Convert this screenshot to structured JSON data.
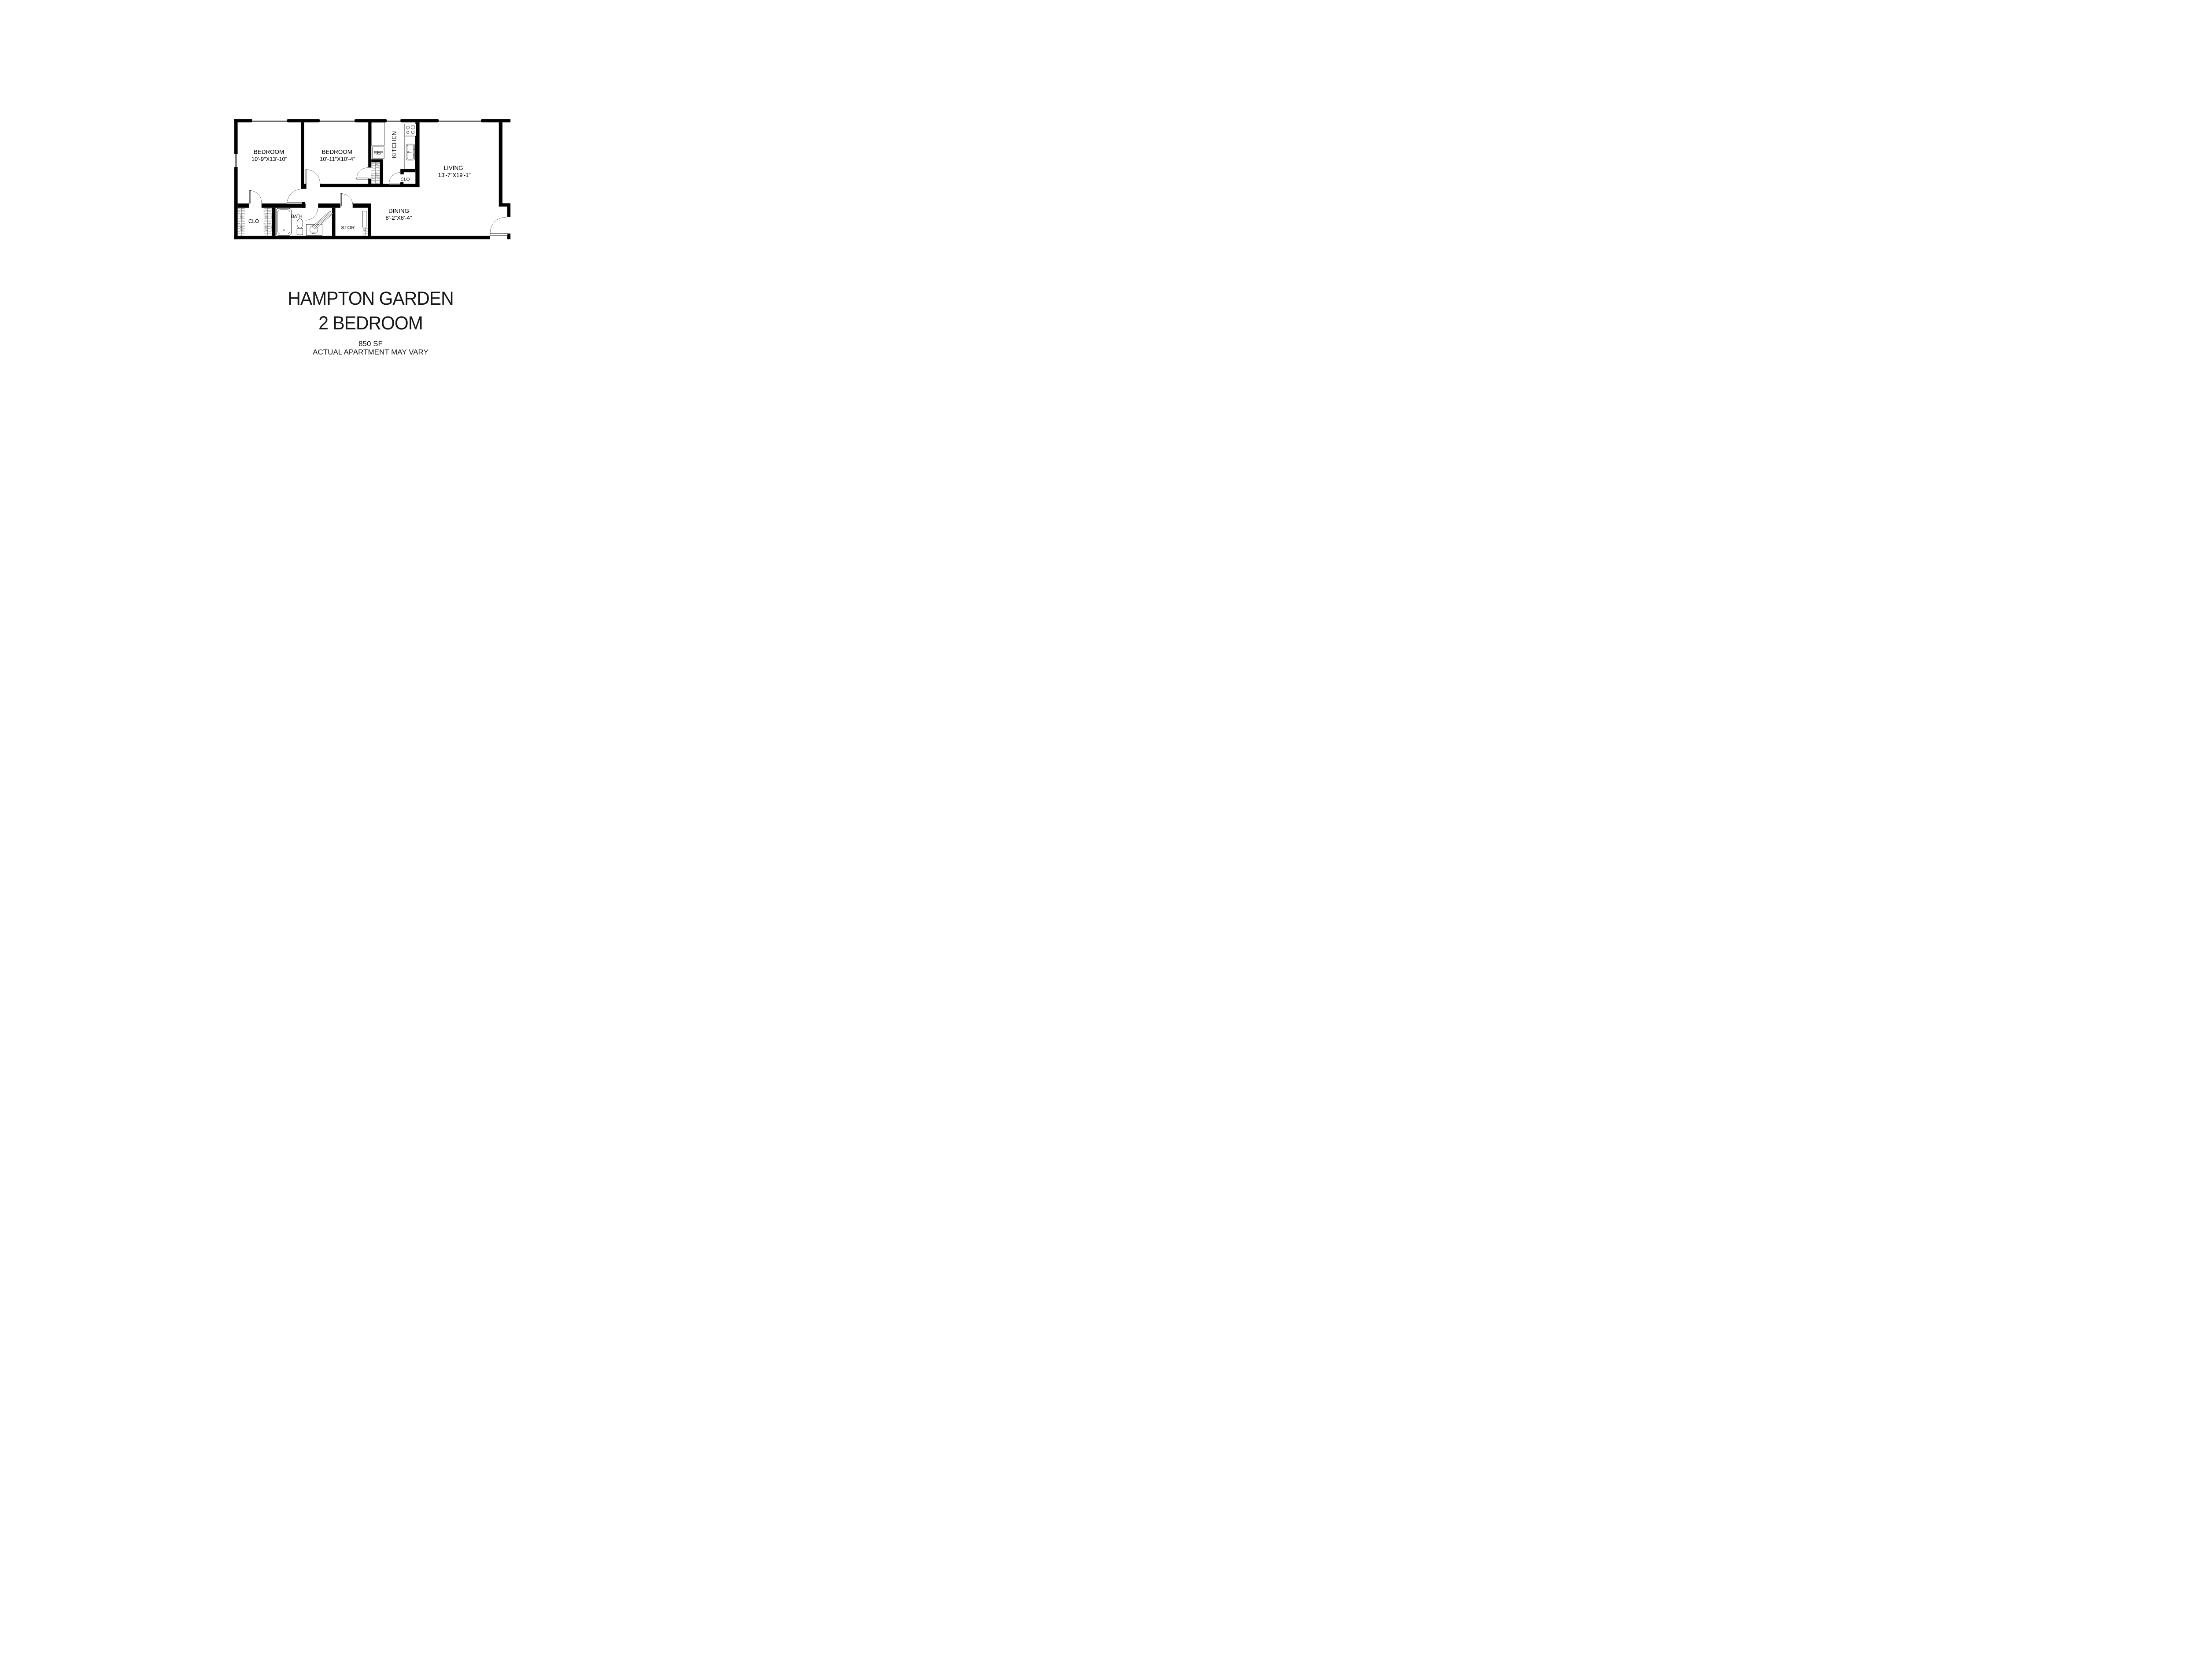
{
  "page": {
    "background": "#ffffff",
    "line_color": "#000000"
  },
  "floor_plan": {
    "rooms": {
      "bedroom1": {
        "label": "BEDROOM",
        "dims": "10'-9\"X13'-10\""
      },
      "bedroom2": {
        "label": "BEDROOM",
        "dims": "10'-11\"X10'-4\""
      },
      "living": {
        "label": "LIVING",
        "dims": "13'-7\"X19'-1\""
      },
      "dining": {
        "label": "DINING",
        "dims": "8'-2\"X8'-4\""
      },
      "kitchen": {
        "label": "KITCHEN"
      },
      "bath": {
        "label": "BATH"
      },
      "storage": {
        "label": "STOR"
      },
      "closet_hall": {
        "label": "CLO"
      },
      "closet_kitchen": {
        "label": "CLO"
      },
      "refrigerator": {
        "label": "REF"
      }
    }
  },
  "title_block": {
    "line1": "HAMPTON GARDEN",
    "line2": "2 BEDROOM",
    "area": "850 SF",
    "disclaimer": "ACTUAL APARTMENT MAY VARY"
  }
}
